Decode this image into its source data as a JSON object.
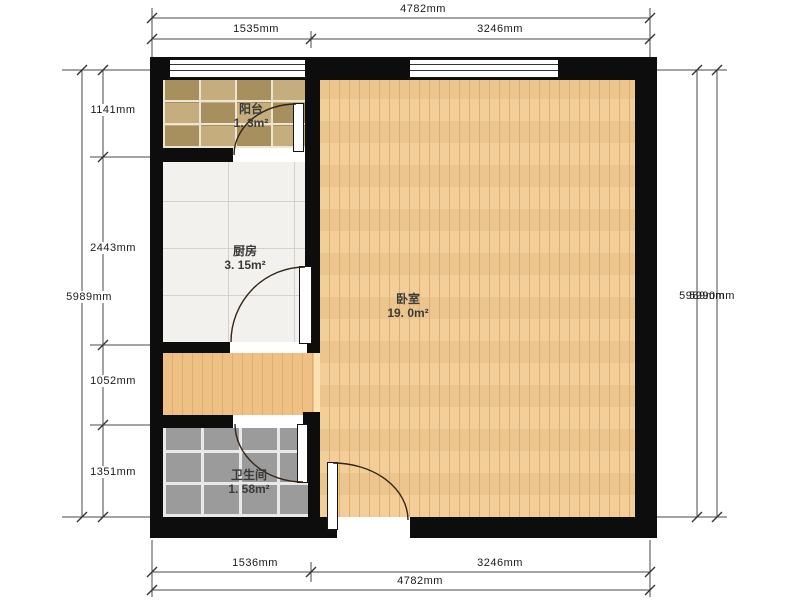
{
  "rooms": {
    "balcony": {
      "label": "阳台",
      "area": "1. 3m²"
    },
    "kitchen": {
      "label": "厨房",
      "area": "3. 15m²"
    },
    "bedroom": {
      "label": "卧室",
      "area": "19. 0m²"
    },
    "bathroom": {
      "label": "卫生间",
      "area": "1. 58m²"
    }
  },
  "dimensions": {
    "top": {
      "overall": "4782mm",
      "segments": [
        "1535mm",
        "3246mm"
      ]
    },
    "bottom": {
      "overall": "4782mm",
      "segments": [
        "1536mm",
        "3246mm"
      ]
    },
    "left": {
      "overall": "5989mm",
      "segments": [
        "1141mm",
        "2443mm",
        "1052mm",
        "1351mm"
      ]
    },
    "right": {
      "overall_inner": "5989mm",
      "overall_outer": "5990mm"
    }
  },
  "colors": {
    "wall": "#0d0d0d",
    "bedroom_floor": "#f3cb93",
    "hallway_floor": "#efc083",
    "plank_line": "#ddae72",
    "kitchen_floor": "#f2f1ed",
    "kitchen_grout": "#d2d1cc",
    "bathroom_tile": "#9b9b9b",
    "bathroom_grout": "#e9e9e9",
    "balcony_tile_a": "#c5ad7e",
    "balcony_tile_b": "#a8905e",
    "balcony_grout": "#ece5d2",
    "dim_line": "#4a4a4a",
    "dim_text": "#1b1b1b",
    "room_text": "#3a3a3a",
    "door_arc": "#332618"
  }
}
